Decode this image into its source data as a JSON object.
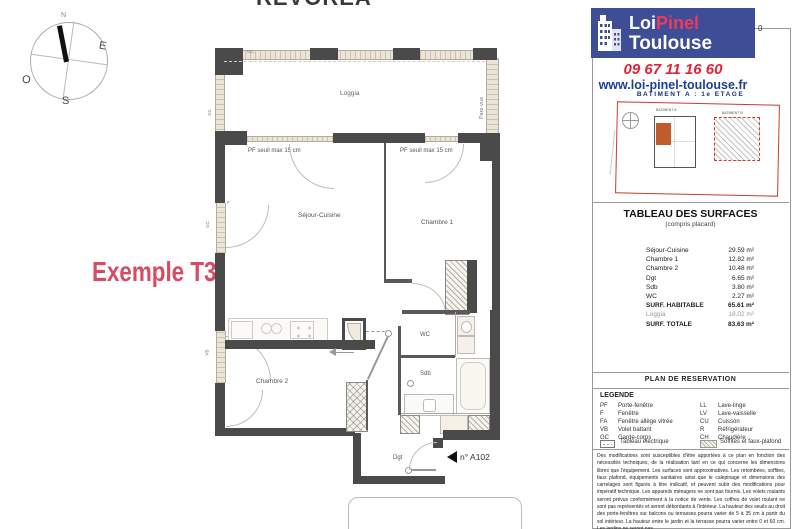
{
  "title_clipped": "REVOREA",
  "compass": {
    "n": "N",
    "e": "E",
    "o": "O",
    "s": "S"
  },
  "example_label": "Exemple T3",
  "plan": {
    "loggia_label": "Loggia",
    "pare_vue_label": "Pare-vue",
    "gc_label": "GC",
    "f_label": "F",
    "vb_label": "VB",
    "pf_left_label": "PF seuil max 15 cm",
    "pf_right_label": "PF seuil max 15 cm",
    "sejour_label": "Séjour-Cuisine",
    "chambre1_label": "Chambre 1",
    "chambre2_label": "Chambre 2",
    "wc_label": "WC",
    "sdb_label": "Sdb",
    "dgt_label": "Dgt",
    "lot_label": "n° A102"
  },
  "sidebar": {
    "logo": {
      "brand_loi": "Loi",
      "brand_pinel": "Pinel",
      "brand_city": "Toulouse"
    },
    "phone": "09 67 11 16 60",
    "website": "www.loi-pinel-toulouse.fr",
    "building_line": "BATIMENT A : 1e ETAGE",
    "fragment": "0",
    "inset": {
      "bat_a": "BATIMENT A",
      "bat_b": "BATIMENT B"
    },
    "surfaces": {
      "title": "TABLEAU DES SURFACES",
      "subtitle": "(compris placard)",
      "rows": [
        {
          "label": "Séjour-Cuisine",
          "value": "29.59 m²"
        },
        {
          "label": "Chambre 1",
          "value": "12.82 m²"
        },
        {
          "label": "Chambre 2",
          "value": "10.48 m²"
        },
        {
          "label": "Dgt",
          "value": "6.65 m²"
        },
        {
          "label": "Sdb",
          "value": "3.80 m²"
        },
        {
          "label": "WC",
          "value": "2.27 m²"
        },
        {
          "label": "SURF. HABITABLE",
          "value": "65.61 m²"
        },
        {
          "label": "Loggia",
          "value": "18.02 m²"
        },
        {
          "label": "SURF. TOTALE",
          "value": "83.63 m²"
        }
      ]
    },
    "reservation_title": "PLAN DE RESERVATION",
    "legend": {
      "title": "LEGENDE",
      "left": [
        {
          "abbr": "PF",
          "label": "Porte-fenêtre"
        },
        {
          "abbr": "F",
          "label": "Fenêtre"
        },
        {
          "abbr": "FA",
          "label": "Fenêtre allège vitrée"
        },
        {
          "abbr": "VB",
          "label": "Volet battant"
        },
        {
          "abbr": "GC",
          "label": "Garde-corps"
        }
      ],
      "right": [
        {
          "abbr": "LL",
          "label": "Lave-linge"
        },
        {
          "abbr": "LV",
          "label": "Lave-vaisselle"
        },
        {
          "abbr": "CU",
          "label": "Cuisson"
        },
        {
          "abbr": "R",
          "label": "Réfrigérateur"
        },
        {
          "abbr": "CH",
          "label": "Chaudière"
        }
      ],
      "elec_label": "Tableau électrique",
      "soffit_label": "Soffites et faux-plafond"
    },
    "disclaimer": "Des modifications sont susceptibles d'être apportées à ce plan en fonction des nécessités techniques, de la réalisation tant en ce qui concerne les dimensions libres que l'équipement. Les surfaces sont approximatives. Les retombées, soffites, faux plafond, équipements sanitaires ainsi que le calepinage et dimensions des carrelages sont figurés à titre indicatif, et peuvent subir des modifications pour impératif technique. Les appareils ménagers ne sont pas fournis. Les volets roulants seront prévus conformément à la notice de vente. Les coffres de volet roulant ne sont pas représentés et seront débordants à l'intérieur. La hauteur des seuils au droit des porte-fenêtres sur balcons ou terrasses pourra varier de 5 à 35 cm à partir du sol intérieur. La hauteur entre le jardin et la terrasse pourra varier entre 0 et 60 cm. Les jardins ne seront pas"
  },
  "colors": {
    "accent_red": "#e02339",
    "brand_blue": "#3d4d96",
    "title_red": "#d84b63",
    "site_red": "#c4402e",
    "unit_orange": "#bf5b2d"
  }
}
